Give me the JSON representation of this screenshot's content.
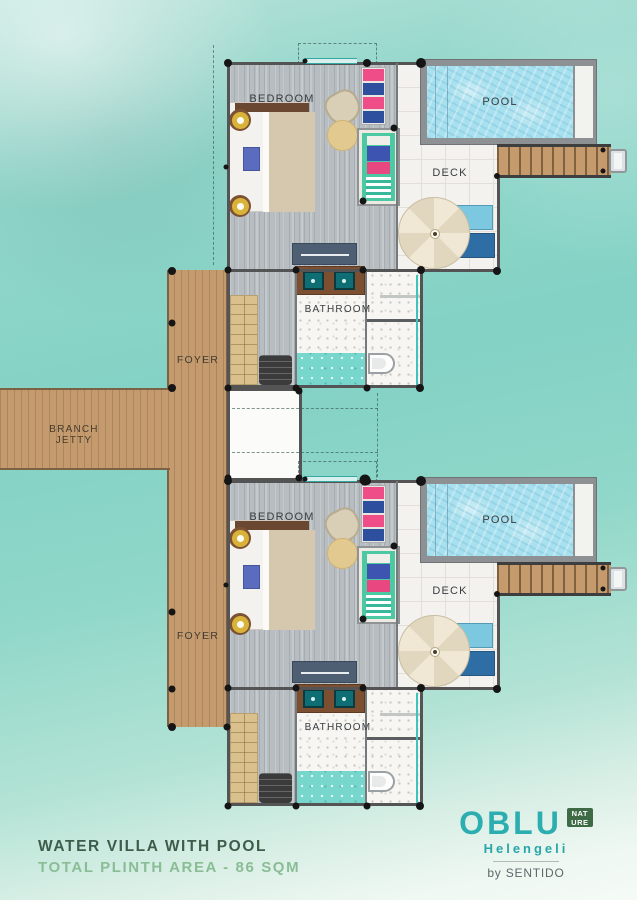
{
  "plan": {
    "unit_labels": {
      "bedroom": "BEDROOM",
      "pool": "POOL",
      "deck": "DECK",
      "bathroom": "BATHROOM"
    },
    "foyer_label": "FOYER",
    "jetty_line1": "BRANCH",
    "jetty_line2": "JETTY"
  },
  "footer": {
    "title_line1": "WATER VILLA WITH POOL",
    "title_line2": "TOTAL PLINTH AREA - 86 SQM"
  },
  "brand": {
    "wordmark": "OBLU",
    "badge_line1": "NAT",
    "badge_line2": "URE",
    "property_name": "Helengeli",
    "byline": "by SENTIDO"
  },
  "colors": {
    "water": "#86d4c8",
    "jetty_wood": "#c59b6d",
    "pool_water": "#a7e0ee",
    "brand_teal": "#2cadb0",
    "badge_green": "#3e6a45",
    "title_green": "#3f5c4b",
    "subtitle_green": "#8abd96"
  }
}
